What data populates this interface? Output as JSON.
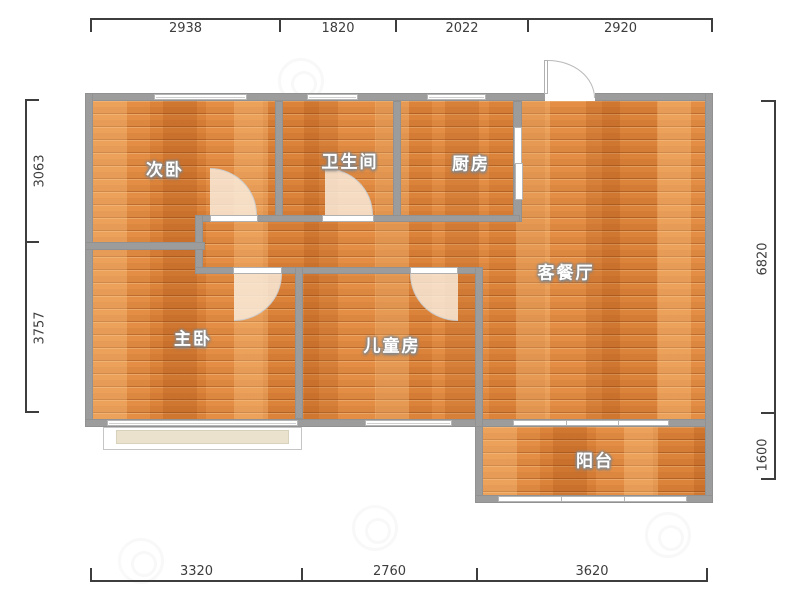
{
  "plan_title": "3-room floor plan",
  "rooms": [
    {
      "name": "secondary-bedroom",
      "label": "次卧"
    },
    {
      "name": "bathroom",
      "label": "卫生间"
    },
    {
      "name": "kitchen",
      "label": "厨房"
    },
    {
      "name": "living-dining-room",
      "label": "客餐厅"
    },
    {
      "name": "master-bedroom",
      "label": "主卧"
    },
    {
      "name": "children-room",
      "label": "儿童房"
    },
    {
      "name": "balcony",
      "label": "阳台"
    }
  ],
  "dimensions": {
    "top": [
      "2938",
      "1820",
      "2022",
      "2920"
    ],
    "left": [
      "3063",
      "3757"
    ],
    "right": [
      "6820",
      "1600"
    ],
    "bottom": [
      "3320",
      "2760",
      "3620"
    ]
  },
  "colors": {
    "wall": "#9c9c9c",
    "floor": "#e1893f",
    "dimension_line": "#3d3d3d",
    "door_arc": "#f9eede",
    "bay_sill": "#eae2cd",
    "window": "#ffffff"
  }
}
